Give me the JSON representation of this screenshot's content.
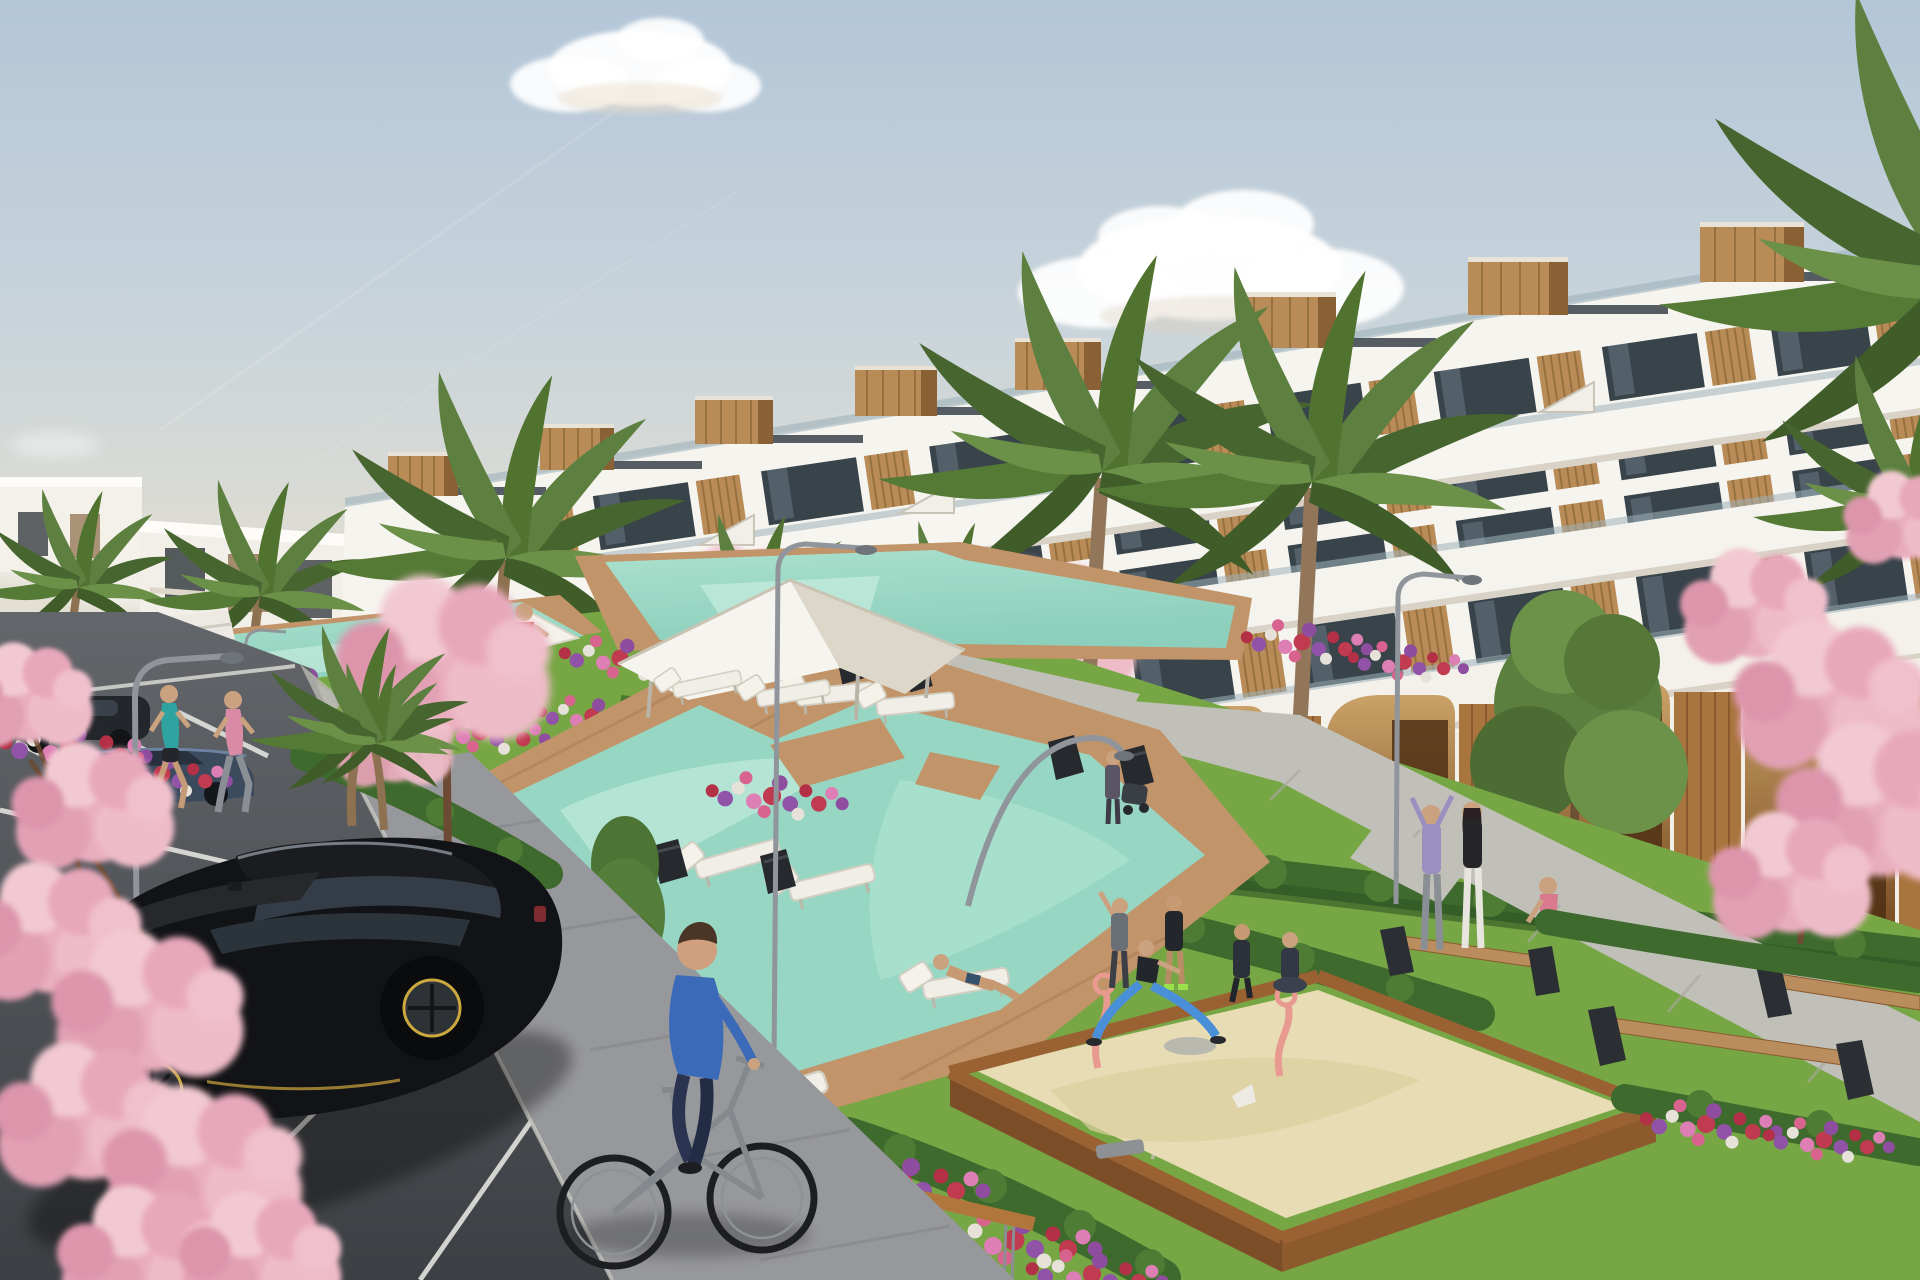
{
  "image": {
    "width": 1920,
    "height": 1280,
    "kind": "3D architectural rendering, no visible text"
  },
  "scene": {
    "title": "Modern residential complex exterior rendering",
    "description": "Photorealistic daytime render of a stepped white apartment complex with wooden accents and rooftop terraces, surrounded by palm trees, cherry blossom trees, turquoise swimming pools with timber decks, lawns with people exercising, a parking lot with a black hatchback, a cyclist, joggers, a playground sandbox and a wooden swing frame under a pale blue sky with scattered clouds.",
    "environment": {
      "time_of_day": "day",
      "weather": "mostly clear",
      "cloud_count": 5
    },
    "colors": {
      "sky_top": "#b3c6d8",
      "sky_mid": "#c9d4da",
      "sky_horizon": "#ece4d3",
      "cloud": "#ffffff",
      "building_white": "#f6f4ef",
      "building_shadow": "#ddd6c9",
      "wood": "#b88b57",
      "wood_dark": "#8a5a2e",
      "glass": "#38434a",
      "roof_strip": "#454c52",
      "arch_ochre": "#c99a5f",
      "arch_inner": "#7a4d22",
      "hedge": "#3e6b2d",
      "grass": "#77a744",
      "grass_light": "#8ab554",
      "palm_green": "#5d8040",
      "palm_dark": "#47662f",
      "blossom_pink": "#e9aebe",
      "flower_red": "#c03a50",
      "flower_purple": "#9053a8",
      "flower_pink": "#dd7fb5",
      "pool_water": "#97d6c3",
      "pool_light": "#c8ecdf",
      "deck_wood": "#c2946a",
      "path_gray": "#c0c0b8",
      "paver_gray": "#97989b",
      "asphalt": "#4e5156",
      "stall_line": "#e3e3df",
      "car_black": "#121316",
      "car_blue": "#3c4a5e",
      "sand": "#e8dcb4",
      "metal_gray": "#8f959b",
      "skin": "#d0a07e"
    },
    "vehicles": [
      {
        "label": "black hatchback, parked diagonally, yellow rim accents",
        "area": "foreground parking lot"
      },
      {
        "label": "dark SUV, parked",
        "area": "upper-left road"
      },
      {
        "label": "dark blue sedan, parked",
        "area": "upper-left road"
      },
      {
        "label": "bicycle ridden by man in blue",
        "area": "foreground paved path"
      }
    ],
    "people": [
      {
        "label": "cyclist",
        "clothing": "blue long-sleeve, dark trousers",
        "activity": "riding bicycle"
      },
      {
        "label": "jogger",
        "clothing": "teal top, black shorts",
        "activity": "running"
      },
      {
        "label": "jogger",
        "clothing": "pink top, grey leggings",
        "activity": "running"
      },
      {
        "label": "man",
        "clothing": "grey outfit",
        "activity": "standing by flower bed"
      },
      {
        "label": "man",
        "clothing": "red shirt",
        "activity": "kicking football near small goal"
      },
      {
        "label": "woman",
        "clothing": "black sports bra, blue leggings",
        "activity": "lunge stretch on lawn"
      },
      {
        "label": "man",
        "clothing": "grey top",
        "activity": "stretching with raised arm"
      },
      {
        "label": "man",
        "clothing": "black tank",
        "activity": "standing on lawn"
      },
      {
        "label": "person",
        "clothing": "dark tracksuit",
        "activity": "kneeling"
      },
      {
        "label": "woman",
        "clothing": "dark outfit",
        "activity": "sitting on lawn"
      },
      {
        "label": "woman with stroller",
        "clothing": "dark",
        "activity": "walking"
      },
      {
        "label": "person",
        "clothing": "lavender top",
        "activity": "arms raised, on walkway"
      },
      {
        "label": "woman",
        "clothing": "black top, white trousers",
        "activity": "standing on walkway"
      },
      {
        "label": "woman",
        "clothing": "pink top",
        "activity": "sitting on pavement"
      },
      {
        "label": "man",
        "clothing": "swimwear",
        "activity": "reclining on white lounger"
      },
      {
        "label": "small figure",
        "clothing": "blue",
        "activity": "walking in distance"
      }
    ],
    "vegetation": {
      "palm_trees": 12,
      "cherry_blossom_trees": 7,
      "green_trees": 5,
      "hedge_rows": 8,
      "flower_beds": 12
    },
    "amenities": {
      "pools": 3,
      "sun_loungers": 13,
      "parasols": 2,
      "benches": 3,
      "wedge_chairs": 6,
      "street_lamps": 4,
      "sandbox": 1,
      "swing_frame": 1,
      "soccer_goal": 1
    },
    "buildings": {
      "apartment_block_floors": 4,
      "rooftop_wood_boxes": 8,
      "ground_floor_arches": 5,
      "distant_low_buildings": 2
    }
  }
}
